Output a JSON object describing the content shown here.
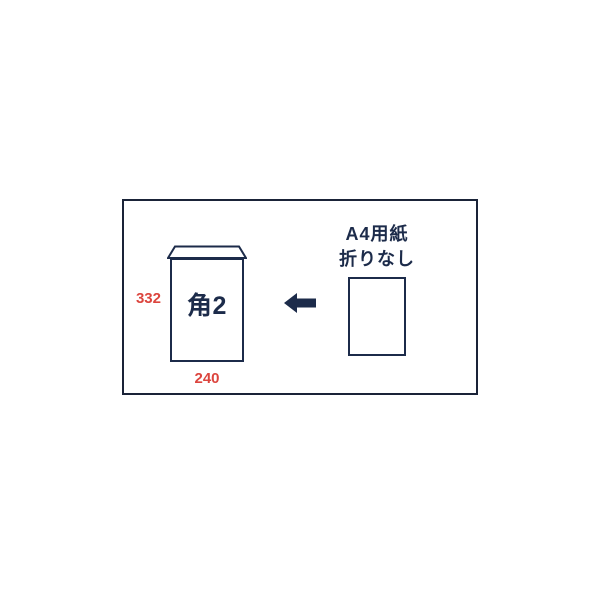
{
  "diagram": {
    "envelope": {
      "size_label": "角2",
      "height_mm": "332",
      "width_mm": "240"
    },
    "paper": {
      "caption_line1": "A4用紙",
      "caption_line2": "折りなし"
    },
    "icons": {
      "arrow": "left-arrow-icon"
    },
    "colors": {
      "outline_navy": "#1c2b4a",
      "dimension_red": "#dc453e",
      "frame_border": "#1a2338",
      "page_bg": "#ffffff"
    }
  }
}
